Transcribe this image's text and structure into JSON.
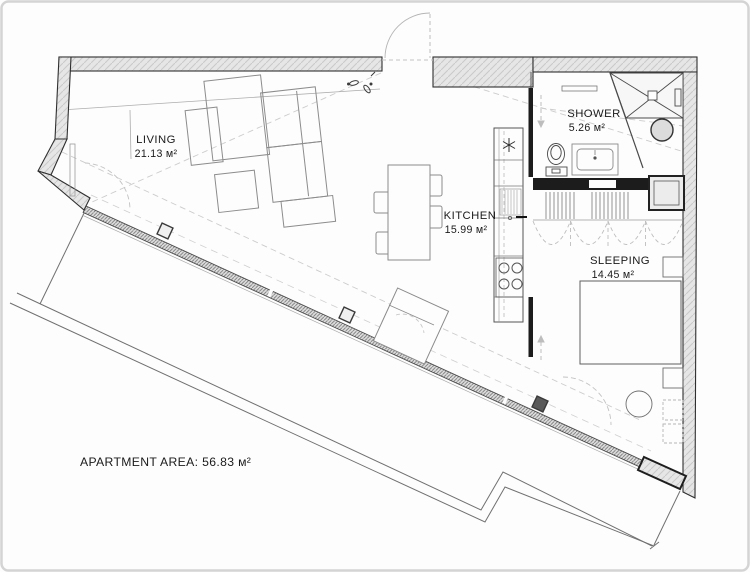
{
  "title": "Apartment floor plan drawing",
  "rooms": {
    "living": {
      "name": "LIVING",
      "area": "21.13 м²"
    },
    "kitchen": {
      "name": "KITCHEN",
      "area": "15.99 м²"
    },
    "shower": {
      "name": "SHOWER",
      "area": "5.26 м²"
    },
    "sleeping": {
      "name": "SLEEPING",
      "area": "14.45 м²"
    }
  },
  "summary": {
    "apartment_area": "APARTMENT AREA: 56.83 м²"
  },
  "icons": {
    "fridge": "snowflake-icon",
    "stove": "four-burner-stove-icon",
    "toilet": "toilet-icon",
    "washer": "washing-machine-icon",
    "shower_tray": "shower-tray-icon",
    "slippers": "slippers-icon"
  },
  "colors": {
    "background": "#fdfdfd",
    "wall_fill": "#e6e6e6",
    "wall_hatch": "#c9c9c9",
    "outline_dark": "#2f2f2f",
    "partition_black": "#1c1c1c",
    "furniture_line": "#8c8c8c",
    "dashed_line": "#c8c8c8",
    "text": "#1b1b1b",
    "frame_border": "#d4d4d4"
  }
}
